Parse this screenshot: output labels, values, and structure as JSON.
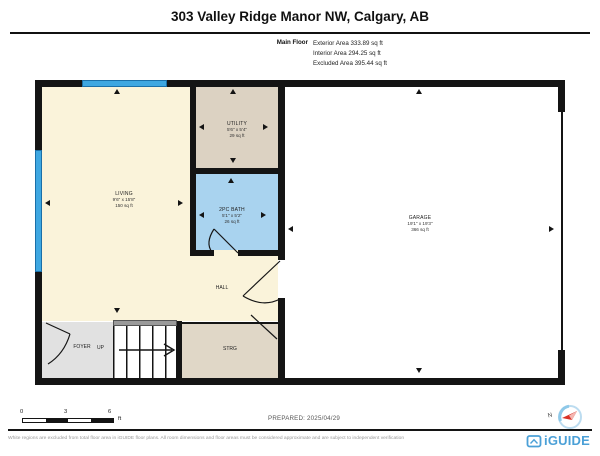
{
  "header": {
    "title": "303 Valley Ridge Manor NW, Calgary, AB"
  },
  "floor_summary": {
    "floor_label": "Main Floor",
    "lines": [
      "Exterior Area 333.89 sq ft",
      "Interior Area 294.25 sq ft",
      "Excluded Area 395.44 sq ft"
    ]
  },
  "rooms": {
    "living": {
      "name": "LIVING",
      "dims": "9'6\" x 15'8\"",
      "area": "150 sq ft"
    },
    "utility": {
      "name": "UTILITY",
      "dims": "5'6\" x 5'4\"",
      "area": "29 sq ft"
    },
    "bath": {
      "name": "2PC BATH",
      "dims": "5'1\" x 5'2\"",
      "area": "26 sq ft"
    },
    "garage": {
      "name": "GARAGE",
      "dims": "19'1\" x 19'3\"",
      "area": "366 sq ft"
    },
    "hall": {
      "name": "HALL"
    },
    "foyer": {
      "name": "FOYER"
    },
    "stairs": {
      "direction_label": "UP"
    },
    "storage": {
      "name": "STRG"
    }
  },
  "scale_bar": {
    "ticks": [
      "0",
      "3",
      "6"
    ],
    "unit": "ft"
  },
  "prepared": {
    "text": "PREPARED: 2025/04/29"
  },
  "compass": {
    "north_label": "N"
  },
  "footer": {
    "disclaimer": "White regions are excluded from total floor area in iGUIDE floor plans. All room dimensions and floor areas must be considered approximate and are subject to independent verification",
    "brand": "iGUIDE"
  },
  "colors": {
    "wall": "#141414",
    "living_fill": "#faf3da",
    "utility_fill": "#dcd2c2",
    "bath_fill": "#a9d3ef",
    "foyer_fill": "#e1e1e1",
    "storage_fill": "#e0d7c7",
    "window_blue": "#3ea7e1",
    "brand_blue": "#4ba0d7"
  }
}
